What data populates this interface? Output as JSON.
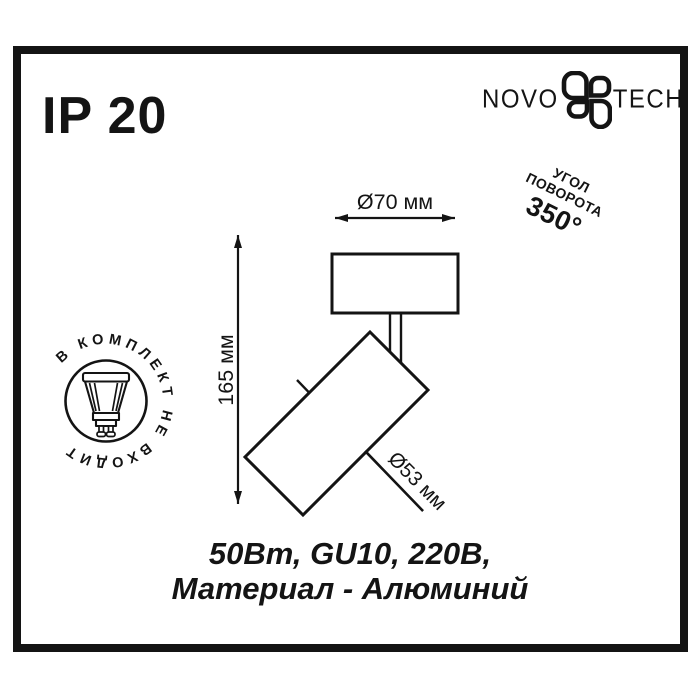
{
  "ip_rating": "IP 20",
  "brand": {
    "left": "NOVO",
    "right": "TECH",
    "icon": "novotech-flower-icon"
  },
  "rotation_badge": {
    "line1": "УГОЛ",
    "line2": "ПОВОРОТА",
    "angle": "350°"
  },
  "stamp": {
    "circular_text": "В КОМПЛЕКТ НЕ ВХОДИТ",
    "icon": "gu10-bulb-icon"
  },
  "dimensions": {
    "top_width": "Ø70 мм",
    "height": "165 мм",
    "body_diameter": "Ø53 мм"
  },
  "specs": {
    "line1": "50Вт, GU10, 220В,",
    "line2": "Материал - Алюминий"
  },
  "colors": {
    "ink": "#141414",
    "background": "#ffffff"
  }
}
